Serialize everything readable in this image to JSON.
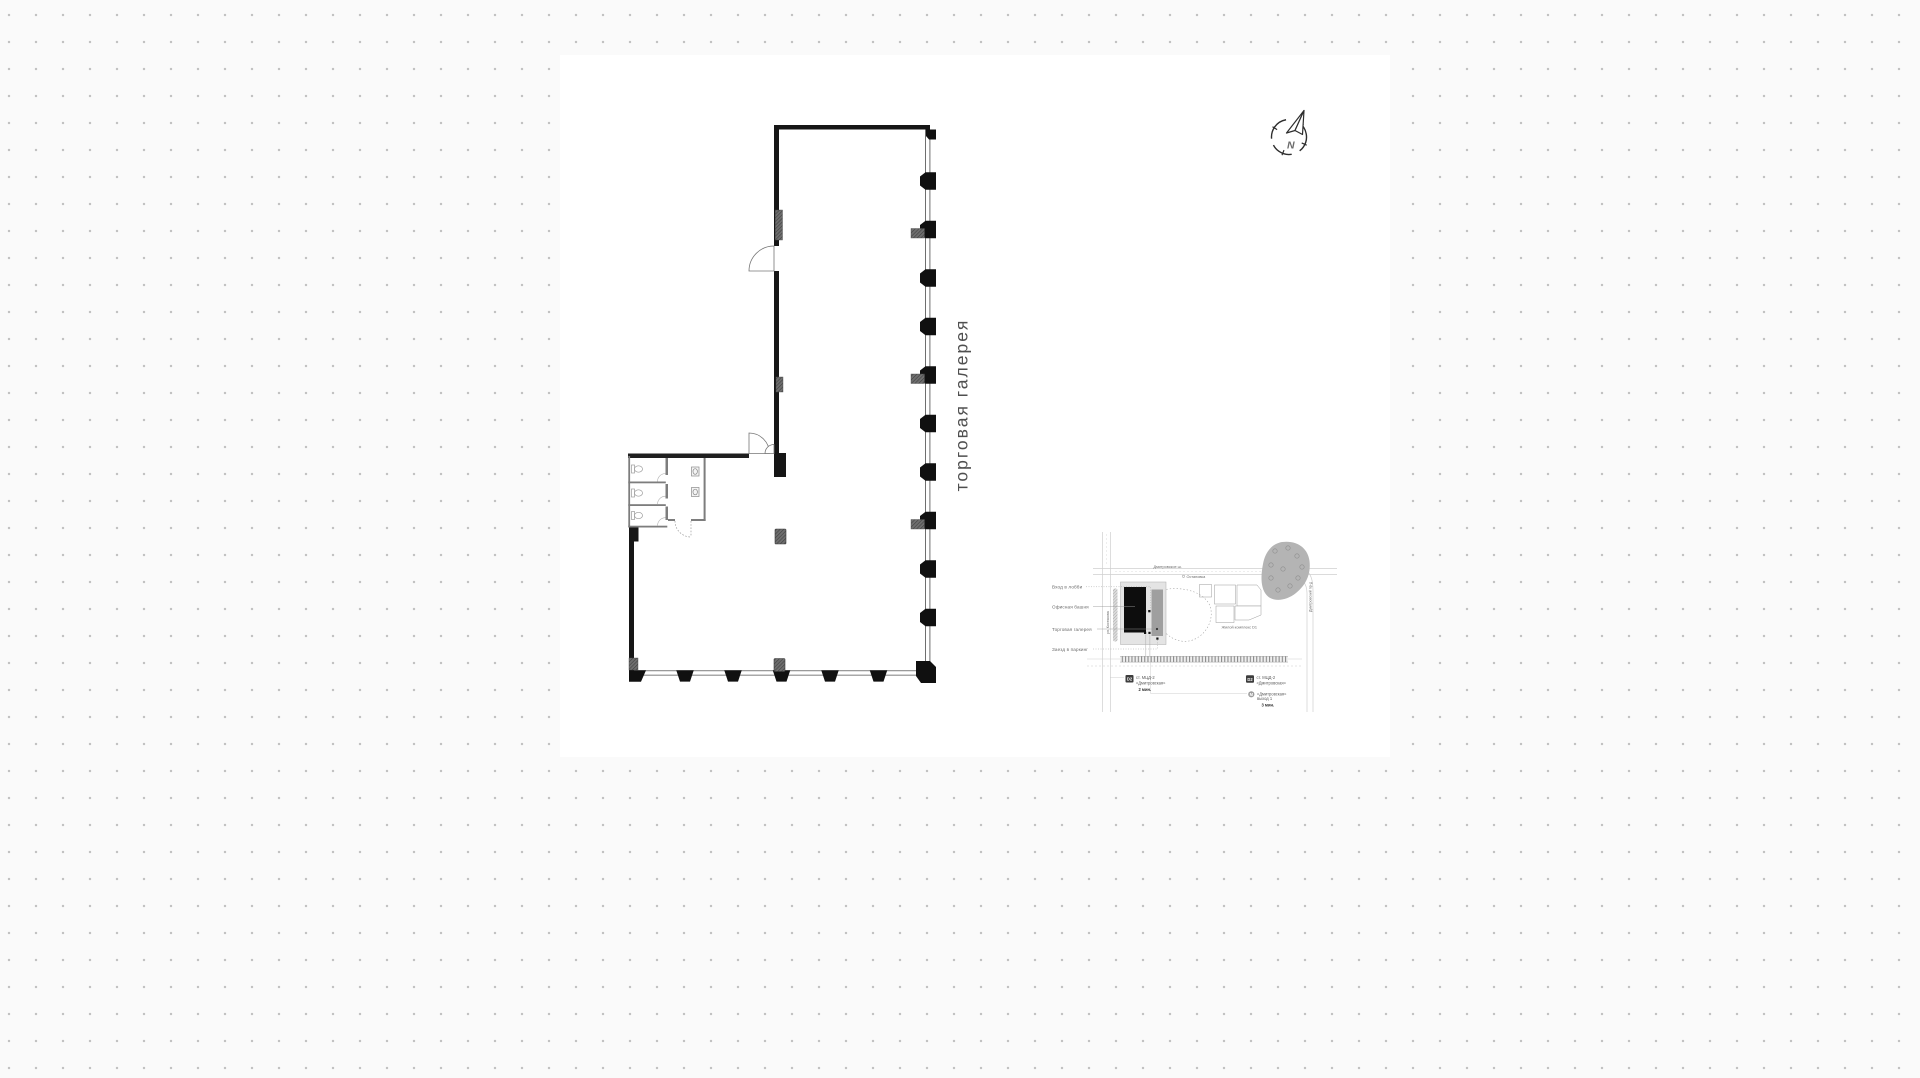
{
  "plan": {
    "gallery_label": "торговая галерея"
  },
  "compass": {
    "north_label": "N"
  },
  "map": {
    "callouts": [
      {
        "label": "Вход в лобби"
      },
      {
        "label": "Офисная башня"
      },
      {
        "label": "Торговая галерея"
      },
      {
        "label": "Заезд в паркинг"
      }
    ],
    "streets": {
      "top_road": "Дмитровское ш.",
      "right_road": "Дмитровский пр-д",
      "left_street": "ул. Костякова",
      "bus_stop": "Остановка",
      "complex": "Жилой комплекс D1"
    },
    "stations": {
      "left": {
        "badge": "D2",
        "line1": "ст. МЦД-2",
        "line2": "«Дмитровская»",
        "time": "2 мин."
      },
      "right": {
        "badge": "D2",
        "line1": "ст. МЦД-2",
        "line2": "«Дмитровская»"
      },
      "metro": {
        "badge": "М",
        "line1": "«Дмитровская»",
        "line2": "выход 1",
        "time": "3 мин."
      }
    }
  },
  "colors": {
    "paper": "#ffffff",
    "background_dot": "#c2c2c2",
    "wall": "#161616",
    "glazing": "#6f6f6f",
    "shaft_marker": "#565656",
    "label_gray": "#4f4f4f",
    "map_tower": "#0d0d0d",
    "map_gallery": "#9f9f9f",
    "map_site": "#e4e4e4",
    "map_park": "#b4b4b4",
    "badge_dark": "#3d3d3d",
    "metro_gray": "#9c9c9c"
  }
}
